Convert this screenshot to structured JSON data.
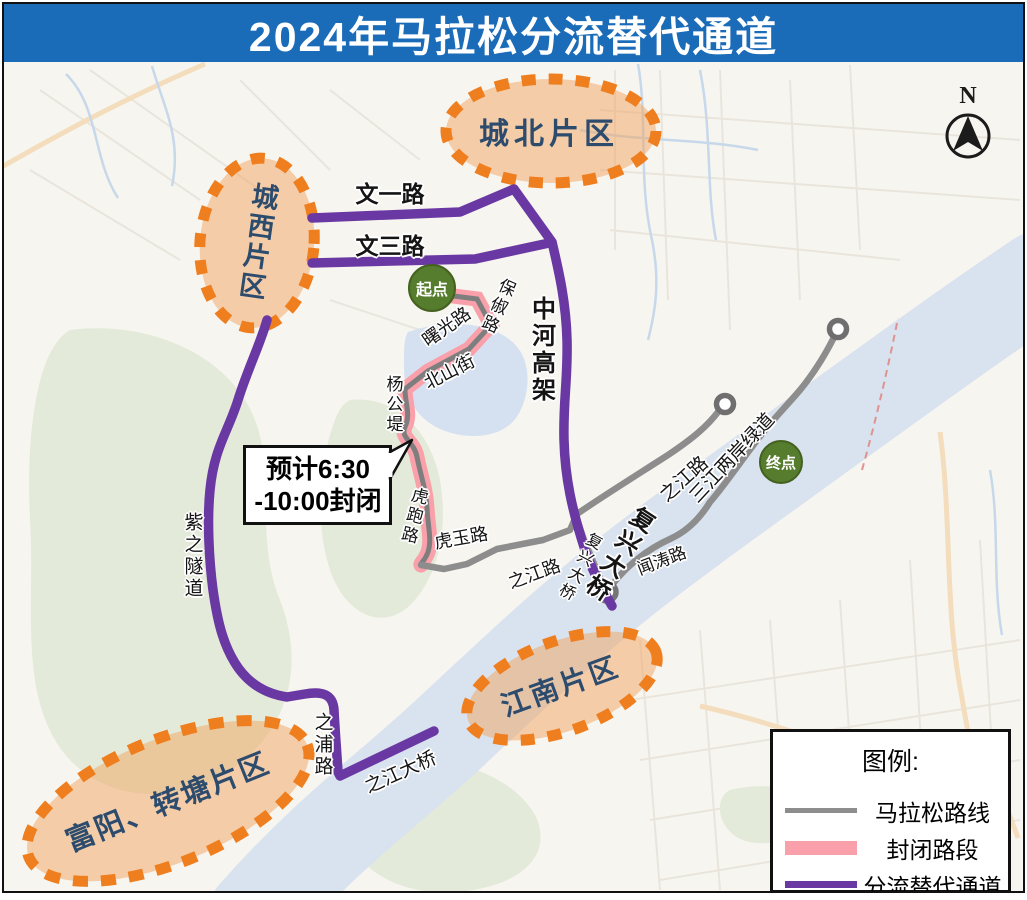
{
  "title": "2024年马拉松分流替代通道",
  "compass_label": "N",
  "districts": {
    "chengbei": "城北片区",
    "chengxi": "城西片区",
    "jiangnan": "江南片区",
    "fuyang": "富阳、转塘片区"
  },
  "markers": {
    "start": "起点",
    "finish": "终点"
  },
  "callout": {
    "line1": "预计6:30",
    "line2": "-10:00封闭"
  },
  "roads": {
    "wenyi": "文一路",
    "wensan": "文三路",
    "zhonghe": "中河高架",
    "shuguang": "曙光路",
    "baochu": "保俶路",
    "beishan": "北山街",
    "yanggongdi": "杨公堤",
    "hupao": "虎跑路",
    "huyu": "虎玉路",
    "zhijiang_west": "之江路",
    "fuxing_bridge_small": "复兴大桥",
    "fuxing_bridge_large": "复兴大桥",
    "wentao": "闻涛路",
    "zhijiang_east": "之江路",
    "sanjiang_greenway": "三江两岸绿道",
    "zizhi_tunnel": "紫之隧道",
    "zhipu": "之浦路",
    "zhijiang_bridge": "之江大桥"
  },
  "legend": {
    "title": "图例:",
    "items": [
      {
        "label": "马拉松路线",
        "color": "#8d8d8d"
      },
      {
        "label": "封闭路段",
        "color": "#f9a0aa"
      },
      {
        "label": "分流替代通道",
        "color": "#6a38a3"
      }
    ]
  },
  "colors": {
    "title_bar": "#1a6bb8",
    "diversion_route": "#6a38a3",
    "closed_section": "#f9a0aa",
    "marathon_route": "#8d8d8d",
    "district_border": "#ee7e1e",
    "district_text": "#2d4c6d",
    "marker_green": "#567c2d"
  }
}
